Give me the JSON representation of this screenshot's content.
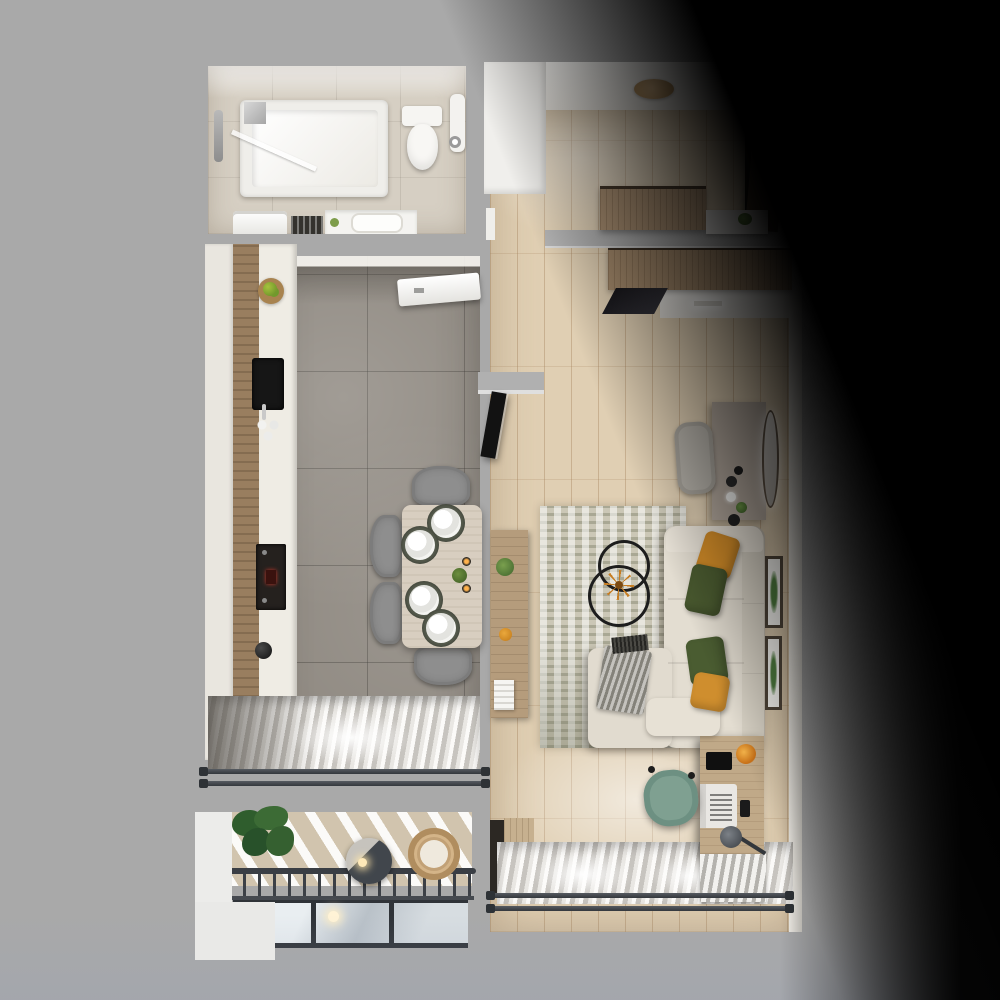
{
  "scene": {
    "kind": "top-down 3d apartment floor plan render",
    "background": "gray studio backdrop with black diagonal shadow over the top-right and right side",
    "rooms": [
      {
        "name": "bathroom",
        "position": "top-left",
        "floor": "beige stone tile",
        "items": [
          "bathtub",
          "shower-screen",
          "shower-column",
          "toilet",
          "towel-rail",
          "paper-holder",
          "washing-machine",
          "vanity-with-basin",
          "towel-niche"
        ]
      },
      {
        "name": "kitchen-dining",
        "position": "left-center",
        "floor": "large gray marble tiles",
        "items": [
          "cabinet-run",
          "fruit-bowl",
          "black-sink",
          "glass-set",
          "built-in-oven",
          "kettle",
          "air-conditioner",
          "dining-table",
          "four-place-settings",
          "two-candles",
          "table-plant",
          "four-gray-chairs",
          "sheer-curtains",
          "window-railing"
        ]
      },
      {
        "name": "balcony",
        "position": "bottom-left",
        "floor": "sunlit wood deck",
        "items": [
          "monstera-plant",
          "pendant-lamp",
          "wicker-chair",
          "metal-railing",
          "glazing-panels"
        ]
      },
      {
        "name": "hallway",
        "position": "top-right",
        "floor": "light oak planks",
        "items": [
          "entrance-door",
          "round-ceiling-lamp",
          "upper-wardrobe",
          "shelf-with-plant",
          "lower-wardrobe",
          "wardrobe-mirror",
          "led-ceiling-light",
          "closet-block"
        ]
      },
      {
        "name": "living-room",
        "position": "right",
        "floor": "light oak planks",
        "items": [
          "tv",
          "tv-console",
          "console-plant",
          "console-decor",
          "console-books",
          "area-rug",
          "l-shaped-sofa",
          "chaise",
          "throw-blanket",
          "orange-pillows",
          "green-pillows",
          "double-ring-chandelier",
          "vanity-table",
          "oval-wall-mirror",
          "vanity-chair",
          "two-botanical-wall-prints",
          "desk",
          "laptop",
          "tablet",
          "smartphone",
          "desk-lamp",
          "orange-desk-decor",
          "teal-office-chair",
          "sheer-curtains",
          "window-railing",
          "radiator",
          "window-cabinet"
        ]
      }
    ],
    "palette": {
      "backdrop_gray": "#a9a9a9",
      "shadow_black": "#000000",
      "bath_tile": "#d6cfc3",
      "kitchen_tile": "#8f8981",
      "wood_floor": "#e0cfb3",
      "cabinet_wood": "#997e5f",
      "wardrobe_wood": "#ad9274",
      "entrance_door": "#4a3a2b",
      "sofa_beige": "#e3ddd1",
      "pillow_orange": "#d28c28",
      "pillow_green": "#49592f",
      "rug": "#cbc7b6",
      "dining_chair_gray": "#8e8e8e",
      "table_wood": "#d8cec0",
      "desk_wood": "#c0a988",
      "office_chair_teal": "#7fa091",
      "railing_dark": "#3c4046",
      "oven_display_red": "#c3372b"
    }
  }
}
